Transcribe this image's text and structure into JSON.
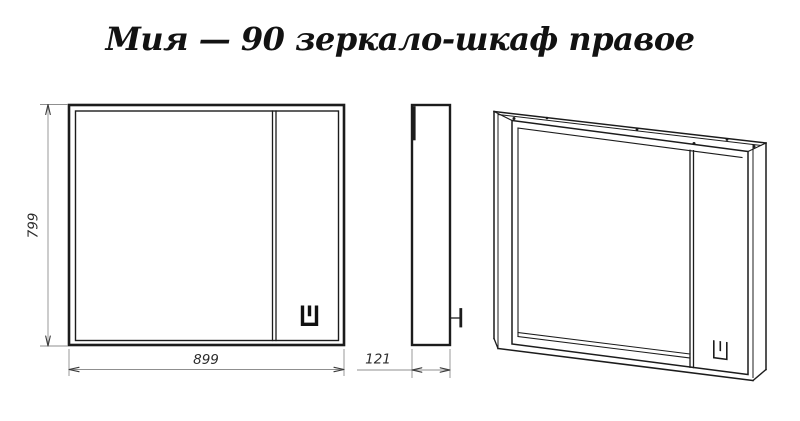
{
  "title": "Мия — 90 зеркало-шкаф правое",
  "dimensions": {
    "height_mm": "799",
    "width_mm": "899",
    "depth_mm": "121"
  },
  "logo": {
    "name": "brand-mark",
    "shape": "u-outline-with-center-stub"
  },
  "views": {
    "count": 3,
    "types": [
      "front",
      "side",
      "perspective"
    ]
  },
  "colors": {
    "background": "#ffffff",
    "drawing_line": "#1c1c1c",
    "dimension_line": "#8f8f8f",
    "dimension_text": "#2b2b2b",
    "title_text": "#121212"
  }
}
